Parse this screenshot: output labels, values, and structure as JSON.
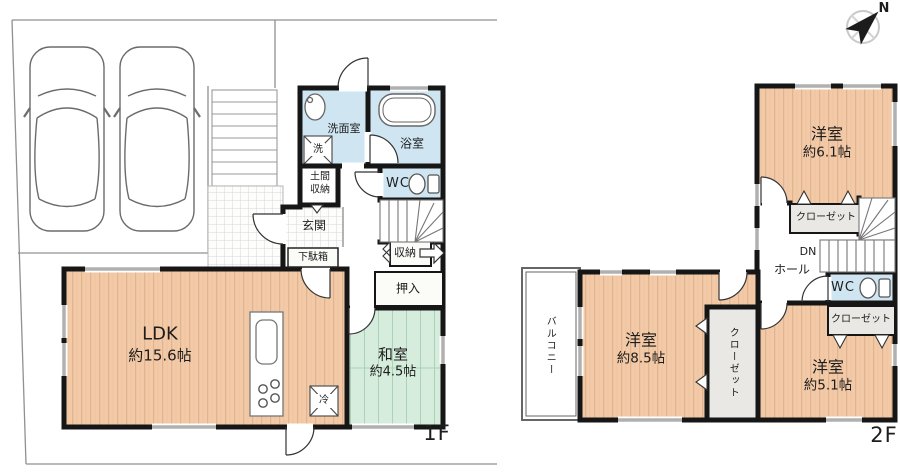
{
  "compass": {
    "north_label": "N"
  },
  "colors": {
    "wood_floor": "#f3caa8",
    "tatami_green": "#d6ecdc",
    "water_blue": "#cfe6f2",
    "wall_black": "#161616",
    "closet_gray": "#e9e8e4",
    "boundary_gray": "#909090"
  },
  "floor1": {
    "label": "1F",
    "ldk": {
      "name": "LDK",
      "area": "約15.6帖"
    },
    "washitsu": {
      "name": "和室",
      "area": "約4.5帖"
    },
    "senmenshitsu": "洗面室",
    "washer": "洗",
    "bathroom": "浴室",
    "toilet": "WC",
    "doma_1": "土間",
    "doma_2": "収納",
    "genkan": "玄関",
    "shoe_cabinet": "下駄箱",
    "storage": "収納",
    "oshiire": "押入",
    "fridge": "冷"
  },
  "floor2": {
    "label": "2F",
    "bedroom_a": {
      "name": "洋室",
      "area": "約6.1帖"
    },
    "bedroom_b": {
      "name": "洋室",
      "area": "約8.5帖"
    },
    "bedroom_c": {
      "name": "洋室",
      "area": "約5.1帖"
    },
    "closet_a": "クローゼット",
    "closet_b": "クローゼット",
    "closet_c": "クローゼット",
    "hall": "ホール",
    "stairs_down": "DN",
    "toilet": "WC",
    "balcony": "バルコニー"
  }
}
